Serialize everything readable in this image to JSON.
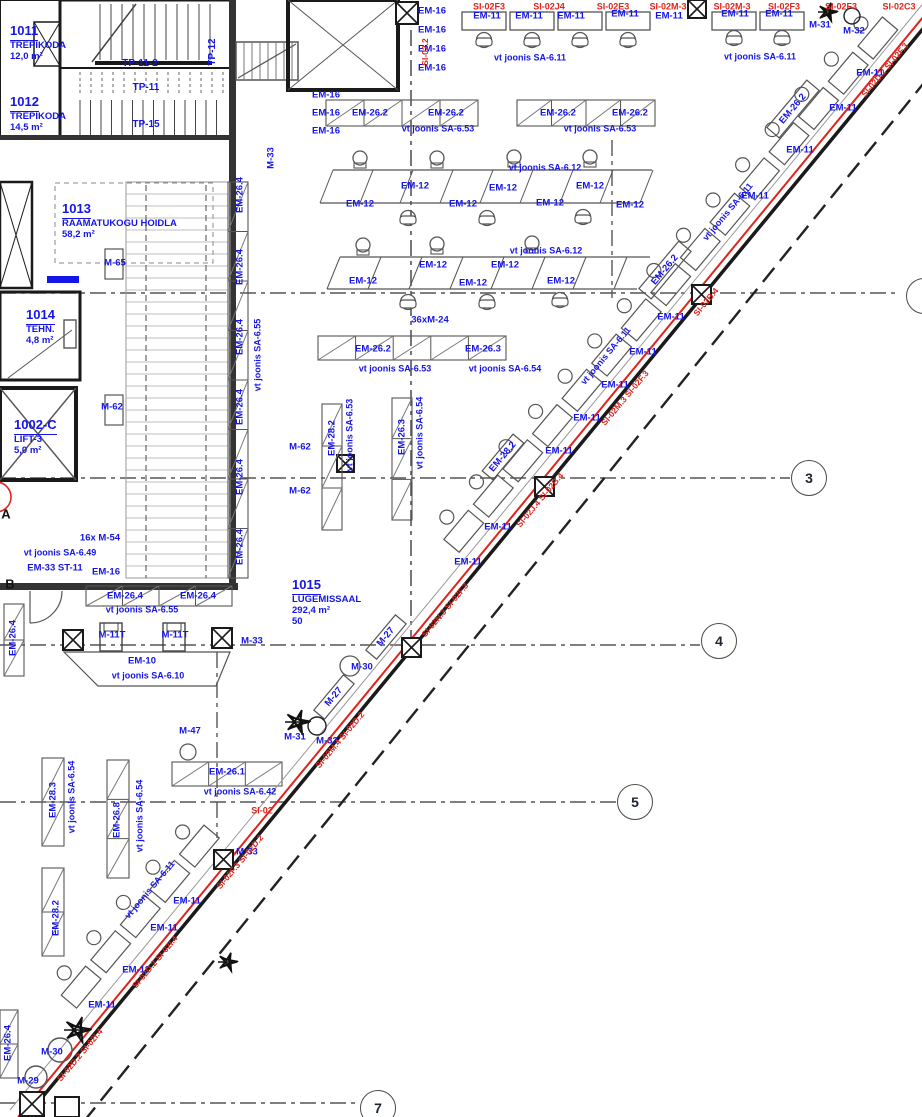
{
  "drawing": {
    "kind": "architectural floor plan (library level)",
    "language": "Estonian",
    "annotation_blue": "#1515e8",
    "marking_red": "#df241c",
    "wall_black": "#1a1a1a",
    "grid_gray": "#555555"
  },
  "rooms": [
    {
      "id": "1011",
      "name": "TREPIKODA",
      "area": "12,0 m²",
      "x": 10,
      "y": 22
    },
    {
      "id": "1012",
      "name": "TREPIKODA",
      "area": "14,5 m²",
      "x": 10,
      "y": 93
    },
    {
      "id": "1013",
      "name": "RAAMATUKOGU HOIDLA",
      "area": "58,2 m²",
      "x": 62,
      "y": 200
    },
    {
      "id": "1014",
      "name": "TEHN.",
      "area": "4,8 m²",
      "x": 26,
      "y": 306
    },
    {
      "id": "1002-C",
      "name": "LIFT-3",
      "area": "5,0 m²",
      "x": 14,
      "y": 416
    },
    {
      "id": "1015",
      "name": "LUGEMISSAAL",
      "area": "292,4 m²",
      "extra": "50",
      "x": 292,
      "y": 576
    }
  ],
  "grid_bubbles": [
    {
      "label": "3",
      "x": 809,
      "y": 478
    },
    {
      "label": "4",
      "x": 719,
      "y": 641
    },
    {
      "label": "5",
      "x": 635,
      "y": 802
    },
    {
      "label": "7",
      "x": 378,
      "y": 1108
    },
    {
      "label": "",
      "x": 924,
      "y": 296
    }
  ],
  "grid_letters": [
    {
      "label": "A",
      "x": 6,
      "y": 514
    },
    {
      "label": "B",
      "x": 10,
      "y": 584
    }
  ],
  "labels": [
    {
      "t": "TP-11-2",
      "x": 140,
      "y": 64,
      "s": 10
    },
    {
      "t": "TP-11",
      "x": 146,
      "y": 88,
      "s": 10
    },
    {
      "t": "TP-15",
      "x": 146,
      "y": 125,
      "s": 10
    },
    {
      "t": "TP-12",
      "x": 213,
      "y": 52,
      "r": -90,
      "s": 10
    },
    {
      "t": "M-33",
      "x": 271,
      "y": 158,
      "r": -90
    },
    {
      "t": "EM-16",
      "x": 432,
      "y": 11
    },
    {
      "t": "EM-16",
      "x": 432,
      "y": 30
    },
    {
      "t": "EM-16",
      "x": 432,
      "y": 49
    },
    {
      "t": "EM-16",
      "x": 432,
      "y": 68
    },
    {
      "t": "EM-16",
      "x": 326,
      "y": 95
    },
    {
      "t": "EM-16",
      "x": 326,
      "y": 113
    },
    {
      "t": "EM-16",
      "x": 326,
      "y": 131
    },
    {
      "t": "SI-02.2",
      "x": 425,
      "y": 52,
      "r": -90,
      "c": "r",
      "s": 8.5
    },
    {
      "t": "SI-02F3",
      "x": 489,
      "y": 7,
      "c": "r",
      "s": 9
    },
    {
      "t": "SI-02J4",
      "x": 549,
      "y": 7,
      "c": "r",
      "s": 9
    },
    {
      "t": "SI-02E3",
      "x": 613,
      "y": 7,
      "c": "r",
      "s": 9
    },
    {
      "t": "SI-02M-3",
      "x": 668,
      "y": 7,
      "c": "r",
      "s": 9
    },
    {
      "t": "SI-02M-3",
      "x": 732,
      "y": 7,
      "c": "r",
      "s": 9
    },
    {
      "t": "SI-02F3",
      "x": 784,
      "y": 7,
      "c": "r",
      "s": 9
    },
    {
      "t": "SI-02F3",
      "x": 841,
      "y": 7,
      "c": "r",
      "s": 9
    },
    {
      "t": "SI-02C3",
      "x": 899,
      "y": 7,
      "c": "r",
      "s": 9
    },
    {
      "t": "EM-11",
      "x": 487,
      "y": 16
    },
    {
      "t": "EM-11",
      "x": 529,
      "y": 16
    },
    {
      "t": "EM-11",
      "x": 571,
      "y": 16
    },
    {
      "t": "EM-11",
      "x": 625,
      "y": 14
    },
    {
      "t": "EM-11",
      "x": 669,
      "y": 16
    },
    {
      "t": "EM-11",
      "x": 735,
      "y": 14
    },
    {
      "t": "EM-11",
      "x": 779,
      "y": 14
    },
    {
      "t": "vt joonis SA-6.11",
      "x": 530,
      "y": 58,
      "s": 9
    },
    {
      "t": "vt joonis SA-6.11",
      "x": 760,
      "y": 57,
      "s": 9
    },
    {
      "t": "M-31",
      "x": 820,
      "y": 25
    },
    {
      "t": "M-32",
      "x": 854,
      "y": 31
    },
    {
      "t": "EM-26.2",
      "x": 370,
      "y": 113
    },
    {
      "t": "EM-26.2",
      "x": 446,
      "y": 113
    },
    {
      "t": "EM-26.2",
      "x": 558,
      "y": 113
    },
    {
      "t": "EM-26.2",
      "x": 630,
      "y": 113
    },
    {
      "t": "vt joonis SA-6.53",
      "x": 438,
      "y": 129,
      "s": 9
    },
    {
      "t": "vt joonis SA-6.53",
      "x": 600,
      "y": 129,
      "s": 9
    },
    {
      "t": "EM-12",
      "x": 360,
      "y": 204
    },
    {
      "t": "EM-12",
      "x": 415,
      "y": 186
    },
    {
      "t": "EM-12",
      "x": 463,
      "y": 204
    },
    {
      "t": "EM-12",
      "x": 503,
      "y": 188
    },
    {
      "t": "EM-12",
      "x": 550,
      "y": 203
    },
    {
      "t": "EM-12",
      "x": 590,
      "y": 186
    },
    {
      "t": "EM-12",
      "x": 630,
      "y": 205
    },
    {
      "t": "vt joonis SA-6.12",
      "x": 545,
      "y": 168,
      "s": 9
    },
    {
      "t": "EM-12",
      "x": 363,
      "y": 281
    },
    {
      "t": "EM-12",
      "x": 433,
      "y": 265
    },
    {
      "t": "EM-12",
      "x": 473,
      "y": 283
    },
    {
      "t": "EM-12",
      "x": 505,
      "y": 265
    },
    {
      "t": "EM-12",
      "x": 561,
      "y": 281
    },
    {
      "t": "vt joonis SA-6.12",
      "x": 546,
      "y": 251,
      "s": 9
    },
    {
      "t": "36xM-24",
      "x": 430,
      "y": 320
    },
    {
      "t": "EM-26.2",
      "x": 373,
      "y": 349
    },
    {
      "t": "EM-26.3",
      "x": 483,
      "y": 349
    },
    {
      "t": "vt joonis SA-6.53",
      "x": 395,
      "y": 369,
      "s": 9
    },
    {
      "t": "vt joonis SA-6.54",
      "x": 505,
      "y": 369,
      "s": 9
    },
    {
      "t": "EM-28.2",
      "x": 332,
      "y": 438,
      "r": -90
    },
    {
      "t": "vt joonis SA-6.53",
      "x": 350,
      "y": 435,
      "r": -90,
      "s": 9
    },
    {
      "t": "EM-26.3",
      "x": 402,
      "y": 437,
      "r": -90
    },
    {
      "t": "vt joonis SA-6.54",
      "x": 420,
      "y": 433,
      "r": -90,
      "s": 9
    },
    {
      "t": "M-62",
      "x": 300,
      "y": 447
    },
    {
      "t": "M-62",
      "x": 300,
      "y": 491
    },
    {
      "t": "M-62",
      "x": 112,
      "y": 407
    },
    {
      "t": "M-65",
      "x": 115,
      "y": 263
    },
    {
      "t": "EM-26.4",
      "x": 240,
      "y": 195,
      "r": -90
    },
    {
      "t": "EM-26.4",
      "x": 240,
      "y": 267,
      "r": -90
    },
    {
      "t": "EM-26.4",
      "x": 240,
      "y": 337,
      "r": -90
    },
    {
      "t": "EM-26.4",
      "x": 240,
      "y": 407,
      "r": -90
    },
    {
      "t": "EM-26.4",
      "x": 240,
      "y": 477,
      "r": -90
    },
    {
      "t": "EM-26.4",
      "x": 240,
      "y": 547,
      "r": -90
    },
    {
      "t": "vt joonis SA-6.55",
      "x": 258,
      "y": 355,
      "r": -90,
      "s": 9
    },
    {
      "t": "16x M-54",
      "x": 100,
      "y": 538
    },
    {
      "t": "vt joonis SA-6.49",
      "x": 60,
      "y": 553,
      "s": 9
    },
    {
      "t": "EM-33 ST-11",
      "x": 55,
      "y": 568
    },
    {
      "t": "EM-16",
      "x": 106,
      "y": 572
    },
    {
      "t": "EM-26.4",
      "x": 125,
      "y": 596
    },
    {
      "t": "EM-26.4",
      "x": 198,
      "y": 596
    },
    {
      "t": "vt joonis SA-6.55",
      "x": 142,
      "y": 610,
      "s": 9
    },
    {
      "t": "M-11T",
      "x": 112,
      "y": 635
    },
    {
      "t": "M-11T",
      "x": 175,
      "y": 635
    },
    {
      "t": "M-33",
      "x": 252,
      "y": 641
    },
    {
      "t": "EM-10",
      "x": 142,
      "y": 661
    },
    {
      "t": "vt joonis SA-6.10",
      "x": 148,
      "y": 676,
      "s": 9
    },
    {
      "t": "M-47",
      "x": 190,
      "y": 731
    },
    {
      "t": "EM-26.1",
      "x": 227,
      "y": 772
    },
    {
      "t": "vt joonis SA-6.42",
      "x": 240,
      "y": 792,
      "s": 9
    },
    {
      "t": "SI-02",
      "x": 262,
      "y": 811,
      "c": "r",
      "s": 9
    },
    {
      "t": "M-31",
      "x": 295,
      "y": 737
    },
    {
      "t": "M-32",
      "x": 327,
      "y": 741
    },
    {
      "t": "M-27",
      "x": 386,
      "y": 637,
      "r": -50
    },
    {
      "t": "M-27",
      "x": 334,
      "y": 697,
      "r": -50
    },
    {
      "t": "M-30",
      "x": 362,
      "y": 667
    },
    {
      "t": "M-33",
      "x": 247,
      "y": 852
    },
    {
      "t": "EM-28.3",
      "x": 53,
      "y": 800,
      "r": -90
    },
    {
      "t": "vt joonis SA-6.54",
      "x": 72,
      "y": 797,
      "r": -90,
      "s": 9
    },
    {
      "t": "EM-26.8",
      "x": 117,
      "y": 820,
      "r": -90
    },
    {
      "t": "vt joonis SA-6.54",
      "x": 140,
      "y": 816,
      "r": -90,
      "s": 9
    },
    {
      "t": "EM-28.2",
      "x": 56,
      "y": 918,
      "r": -90
    },
    {
      "t": "EM-26.4",
      "x": 13,
      "y": 638,
      "r": -90
    },
    {
      "t": "EM-26.4",
      "x": 8,
      "y": 1043,
      "r": -90
    },
    {
      "t": "EM-11",
      "x": 870,
      "y": 73
    },
    {
      "t": "EM-11",
      "x": 843,
      "y": 108
    },
    {
      "t": "EM-11",
      "x": 800,
      "y": 150
    },
    {
      "t": "EM-11",
      "x": 755,
      "y": 196
    },
    {
      "t": "EM-11",
      "x": 671,
      "y": 317
    },
    {
      "t": "EM-11",
      "x": 643,
      "y": 352
    },
    {
      "t": "EM-11",
      "x": 615,
      "y": 385
    },
    {
      "t": "EM-11",
      "x": 587,
      "y": 418
    },
    {
      "t": "EM-11",
      "x": 559,
      "y": 451
    },
    {
      "t": "EM-11",
      "x": 498,
      "y": 527
    },
    {
      "t": "EM-11",
      "x": 468,
      "y": 562
    },
    {
      "t": "EM-11",
      "x": 187,
      "y": 901
    },
    {
      "t": "EM-11",
      "x": 164,
      "y": 928
    },
    {
      "t": "EM-11",
      "x": 136,
      "y": 970
    },
    {
      "t": "EM-11",
      "x": 102,
      "y": 1005
    },
    {
      "t": "vt joonis SA-6.11",
      "x": 728,
      "y": 212,
      "r": -50,
      "s": 9
    },
    {
      "t": "vt joonis SA-6.11",
      "x": 606,
      "y": 356,
      "r": -50,
      "s": 9
    },
    {
      "t": "vt joonis SA-6.11",
      "x": 150,
      "y": 890,
      "r": -50,
      "s": 9
    },
    {
      "t": "EM-26.2",
      "x": 793,
      "y": 109,
      "r": -50
    },
    {
      "t": "EM-26.2",
      "x": 665,
      "y": 270,
      "r": -50
    },
    {
      "t": "EM-28.2",
      "x": 503,
      "y": 457,
      "r": -50
    },
    {
      "t": "M-30",
      "x": 52,
      "y": 1052
    },
    {
      "t": "M-29",
      "x": 28,
      "y": 1081
    },
    {
      "t": "SI-02D.2  SI-02F.3",
      "x": 885,
      "y": 70,
      "r": -50,
      "c": "r",
      "s": 8.5
    },
    {
      "t": "SI-02B.4",
      "x": 706,
      "y": 302,
      "r": -50,
      "c": "r",
      "s": 8.5
    },
    {
      "t": "SI-02M.3  SI-02F.3",
      "x": 625,
      "y": 398,
      "r": -50,
      "c": "r",
      "s": 8.5
    },
    {
      "t": "SI-02J.4  SI-02B.4",
      "x": 540,
      "y": 500,
      "r": -50,
      "c": "r",
      "s": 8.5
    },
    {
      "t": "SI-02N.3  SI-02F.3",
      "x": 445,
      "y": 610,
      "r": -50,
      "c": "r",
      "s": 8.5
    },
    {
      "t": "SI-02M.4  SI-02D.2",
      "x": 340,
      "y": 740,
      "r": -50,
      "c": "r",
      "s": 8.5
    },
    {
      "t": "SI-02F.3  SI-02D.2",
      "x": 240,
      "y": 862,
      "r": -50,
      "c": "r",
      "s": 8.5
    },
    {
      "t": "SI-02D.2  SI-02I.4",
      "x": 155,
      "y": 962,
      "r": -50,
      "c": "r",
      "s": 8.5
    },
    {
      "t": "SI-02D.2  SI-02I.4",
      "x": 80,
      "y": 1055,
      "r": -50,
      "c": "r",
      "s": 8.5
    }
  ]
}
